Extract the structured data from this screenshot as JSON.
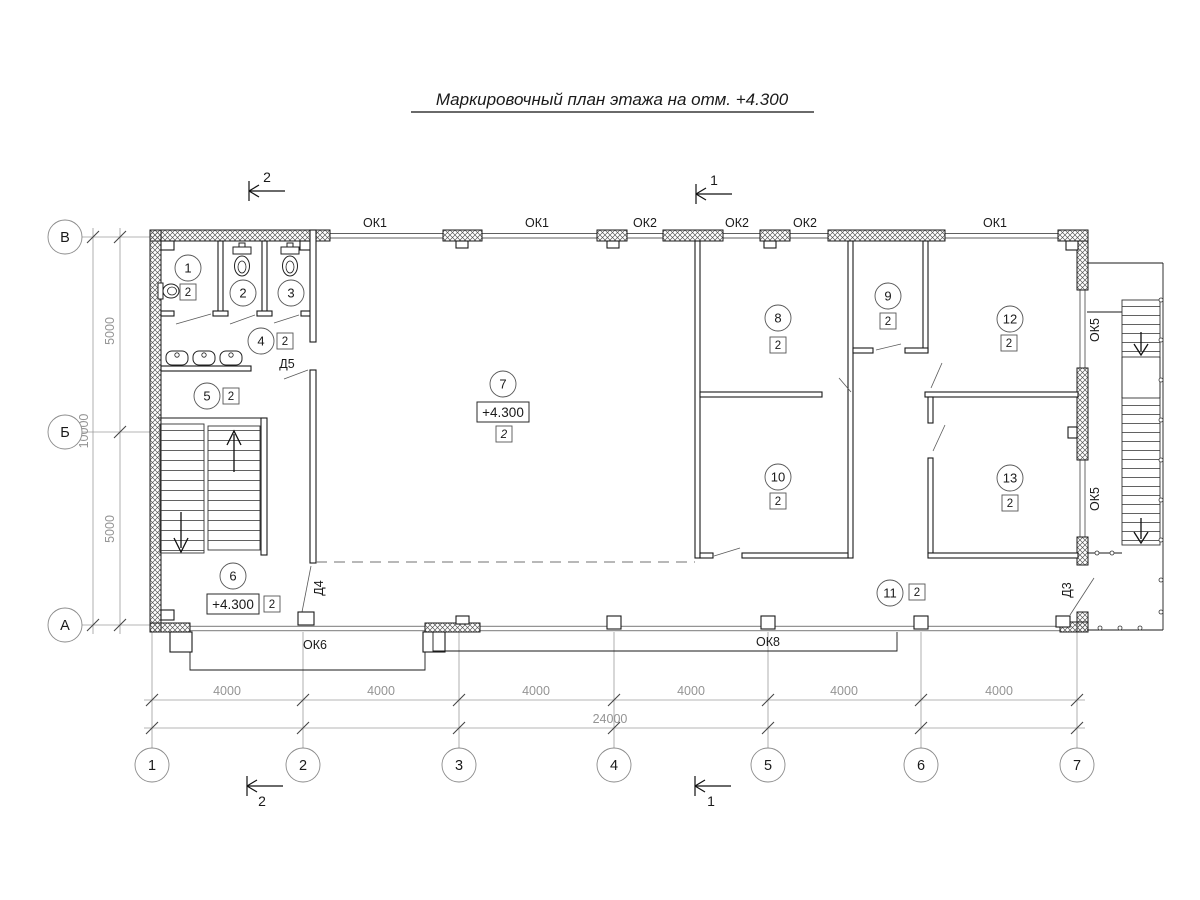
{
  "title": "Маркировочный план этажа на отм. +4.300",
  "axes": {
    "rows": [
      "В",
      "Б",
      "А"
    ],
    "cols": [
      "1",
      "2",
      "3",
      "4",
      "5",
      "6",
      "7"
    ]
  },
  "dims": {
    "col_spans": [
      "4000",
      "4000",
      "4000",
      "4000",
      "4000",
      "4000"
    ],
    "col_total": "24000",
    "row_spans": [
      "5000",
      "5000"
    ],
    "row_total": "10000"
  },
  "sections": {
    "one": "1",
    "two": "2"
  },
  "windows": {
    "top": [
      "ОК1",
      "ОК1",
      "ОК2",
      "ОК2",
      "ОК2",
      "ОК1"
    ],
    "right": [
      "ОК5",
      "ОК5"
    ],
    "bottom_left": "ОК6",
    "bottom_right": "ОК8"
  },
  "doors": {
    "d3": "Д3",
    "d4": "Д4",
    "d5": "Д5"
  },
  "rooms": [
    {
      "num": "1",
      "cat": "2"
    },
    {
      "num": "2"
    },
    {
      "num": "3"
    },
    {
      "num": "4",
      "cat": "2"
    },
    {
      "num": "5",
      "cat": "2"
    },
    {
      "num": "6",
      "cat": "2",
      "elev": "+4.300"
    },
    {
      "num": "7",
      "cat": "2",
      "elev": "+4.300"
    },
    {
      "num": "8",
      "cat": "2"
    },
    {
      "num": "9",
      "cat": "2"
    },
    {
      "num": "10",
      "cat": "2"
    },
    {
      "num": "11",
      "cat": "2"
    },
    {
      "num": "12",
      "cat": "2"
    },
    {
      "num": "13",
      "cat": "2"
    }
  ]
}
